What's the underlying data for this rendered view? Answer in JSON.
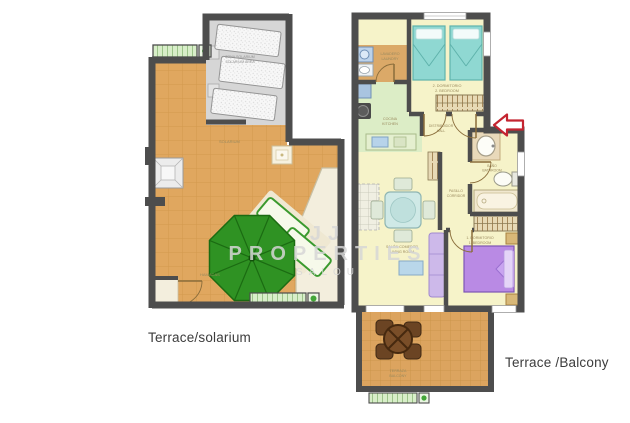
{
  "page": {
    "width": 630,
    "height": 423,
    "background": "#ffffff"
  },
  "watermark": {
    "line1": "JJ PROPERTIES",
    "line2": "SALOU"
  },
  "captions": {
    "left": "Terrace/solarium",
    "right": "Terrace /Balcony"
  },
  "left_plan": {
    "labels": {
      "deck_line1": "ZONA SOLARIUM",
      "deck_line2": "SOLARIUM AREA",
      "floor": "SOLARIUM",
      "sun_area": "HAMACAS"
    }
  },
  "right_plan": {
    "labels": {
      "laundry_line1": "LAVADERO",
      "laundry_line2": "LAUNDRY",
      "bedroom2_line1": "2. DORMITORIO",
      "bedroom2_line2": "2. BEDROOM",
      "kitchen_line1": "COCINA",
      "kitchen_line2": "KITCHEN",
      "entry_line1": "DISTRIBUIDOR",
      "entry_line2": "HALL",
      "hall_line1": "PASILLO",
      "hall_line2": "CORRIDOR",
      "bath_line1": "BAÑO",
      "bath_line2": "BATHROOM",
      "living_line1": "SALÓN COMEDOR",
      "living_line2": "LIVING ROOM",
      "bedroom1_line1": "1. DORMITORIO",
      "bedroom1_line2": "1. BEDROOM",
      "balcony_line1": "TERRAZA",
      "balcony_line2": "BALCONY"
    }
  },
  "colors": {
    "wall": "#4d4d4d",
    "terrace_tile": "#e0a75f",
    "floor_yellow": "#f6f3c9",
    "kitchen_green": "#dcedc6",
    "utility_tan": "#dba968",
    "deck_gray": "#d6d6d6",
    "bed_teal": "#8fd8d2",
    "bed_purple": "#b98ae4",
    "sofa_lavender": "#cdb9ea",
    "parasol_green": "#2f9223",
    "planter_green": "#d8eec9",
    "balcony_table_brown": "#6b4423",
    "arrow_red": "#c42430",
    "caption_text": "#3c3c3c",
    "watermark": "#d6d6d6"
  }
}
